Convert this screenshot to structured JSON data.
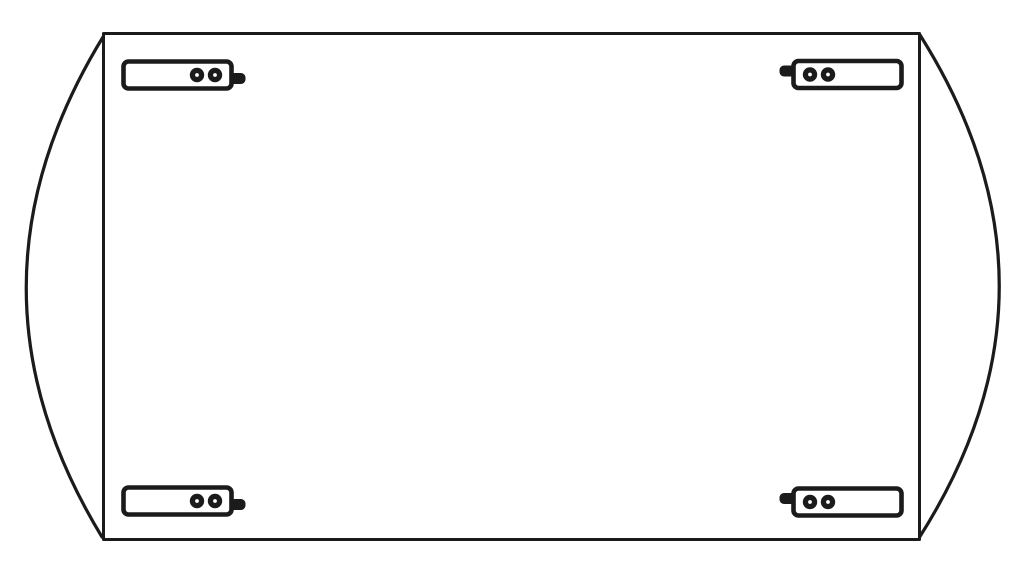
{
  "figure": {
    "kind": "technical line drawing",
    "subject": "rectangular tabletop underside with two curved drop leaves and four corner hinge brackets",
    "colors": {
      "ink": "#1b1b1b",
      "paper": "#ffffff"
    },
    "panel": {
      "shape": "rectangle"
    },
    "leaves": {
      "count": 2,
      "sides": [
        "left",
        "right"
      ],
      "shape": "arc"
    },
    "brackets": {
      "count": 4,
      "screws_per_bracket": 2,
      "positions": [
        "top-left",
        "top-right",
        "bottom-left",
        "bottom-right"
      ]
    },
    "parts": [
      {
        "name": "tabletop-panel"
      },
      {
        "name": "left-drop-leaf"
      },
      {
        "name": "right-drop-leaf"
      },
      {
        "name": "hinge-bracket-top-left"
      },
      {
        "name": "hinge-bracket-top-right"
      },
      {
        "name": "hinge-bracket-bottom-left"
      },
      {
        "name": "hinge-bracket-bottom-right"
      }
    ]
  }
}
